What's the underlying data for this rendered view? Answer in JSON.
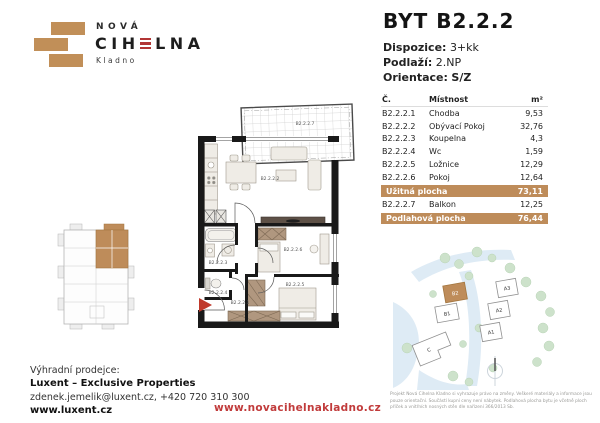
{
  "brand": {
    "nova": "NOVÁ",
    "cihelna_left": "CIH",
    "cihelna_e": "E",
    "cihelna_right": "LNA",
    "city": "Kladno"
  },
  "header": {
    "title": "BYT B2.2.2",
    "dispozice_label": "Dispozice:",
    "dispozice_value": "3+kk",
    "podlazi_label": "Podlaží:",
    "podlazi_value": "2.NP",
    "orientace_label": "Orientace:",
    "orientace_value": "S/Z"
  },
  "table": {
    "col_no": "Č.",
    "col_room": "Místnost",
    "col_area": "m²",
    "rows": [
      {
        "no": "B2.2.2.1",
        "room": "Chodba",
        "area": "9,53"
      },
      {
        "no": "B2.2.2.2",
        "room": "Obývací Pokoj",
        "area": "32,76"
      },
      {
        "no": "B2.2.2.3",
        "room": "Koupelna",
        "area": "4,3"
      },
      {
        "no": "B2.2.2.4",
        "room": "Wc",
        "area": "1,59"
      },
      {
        "no": "B2.2.2.5",
        "room": "Ložnice",
        "area": "12,29"
      },
      {
        "no": "B2.2.2.6",
        "room": "Pokoj",
        "area": "12,64"
      }
    ],
    "uzitna_label": "Užitná plocha",
    "uzitna_value": "73,11",
    "balkon_row": {
      "no": "B2.2.2.7",
      "room": "Balkon",
      "area": "12,25"
    },
    "podlahova_label": "Podlahová plocha",
    "podlahova_value": "76,44"
  },
  "floorplan": {
    "balkon": "B2.2.2.7",
    "obyvaci": "B2.2.2.2",
    "koupelna": "B2.2.2.3",
    "wc": "B2.2.2.4",
    "chodba": "B2.2.2.1",
    "loznice": "B2.2.2.5",
    "pokoj": "B2.2.2.6"
  },
  "siteplan": {
    "a1": "A1",
    "a2": "A2",
    "a3": "A3",
    "b1": "B1",
    "b2": "B2",
    "c": "C"
  },
  "footer": {
    "seller_label": "Výhradní prodejce:",
    "seller_name": "Luxent – Exclusive Properties",
    "seller_contact": "zdenek.jemelik@luxent.cz, +420 720 310 300",
    "seller_web": "www.luxent.cz",
    "project_web": "www.novacihelnakladno.cz",
    "disclaimer": "Projekt Nová Cihelna Kladno si vyhrazuje právo na změny. Veškeré materiály a informace jsou pouze orientační. Součástí kupní ceny není nábytek. Podlahová plocha bytu je včetně ploch příček a vnitřních nosných stěn dle nařízení 366/2013 Sb."
  },
  "colors": {
    "brand_tan": "#be8c5a",
    "accent_red": "#c13b3b",
    "wall_black": "#191919"
  }
}
